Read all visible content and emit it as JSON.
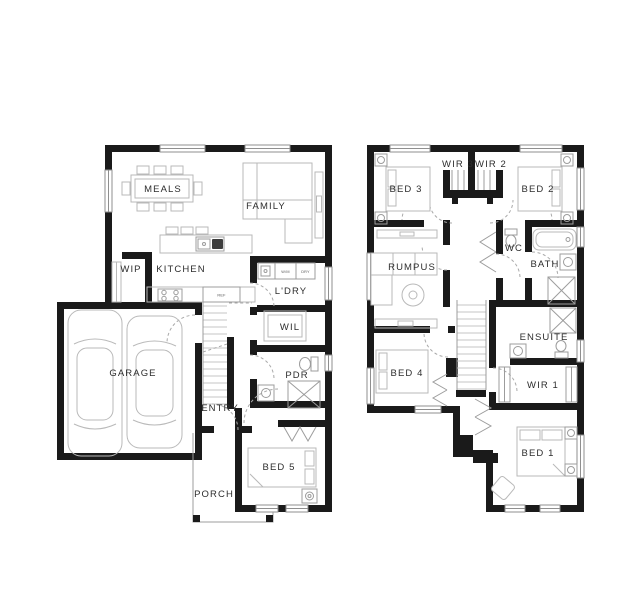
{
  "page": {
    "background": "#ffffff"
  },
  "colors": {
    "wall": "#1a1a1a",
    "furniture_line": "#b9b9b9",
    "door_arc": "#a9a9a9",
    "label": "#2d2d2d"
  },
  "ground_floor": {
    "rooms": {
      "meals": "MEALS",
      "family": "FAMILY",
      "wip": "WIP",
      "kitchen": "KITCHEN",
      "laundry": "L'DRY",
      "wil": "WIL",
      "garage": "GARAGE",
      "pdr": "PDR",
      "entry": "ENTRY",
      "bed5": "BED 5",
      "porch": "PORCH"
    },
    "appliances": {
      "ref": "REF",
      "washer": "W/M",
      "dryer": "DRY"
    }
  },
  "first_floor": {
    "rooms": {
      "wir3": "WIR 3",
      "wir2": "WIR 2",
      "bed3": "BED 3",
      "bed2": "BED 2",
      "rumpus": "RUMPUS",
      "wc": "WC",
      "bath": "BATH",
      "ensuite": "ENSUITE",
      "bed4": "BED 4",
      "wir1": "WIR 1",
      "bed1": "BED 1"
    }
  }
}
